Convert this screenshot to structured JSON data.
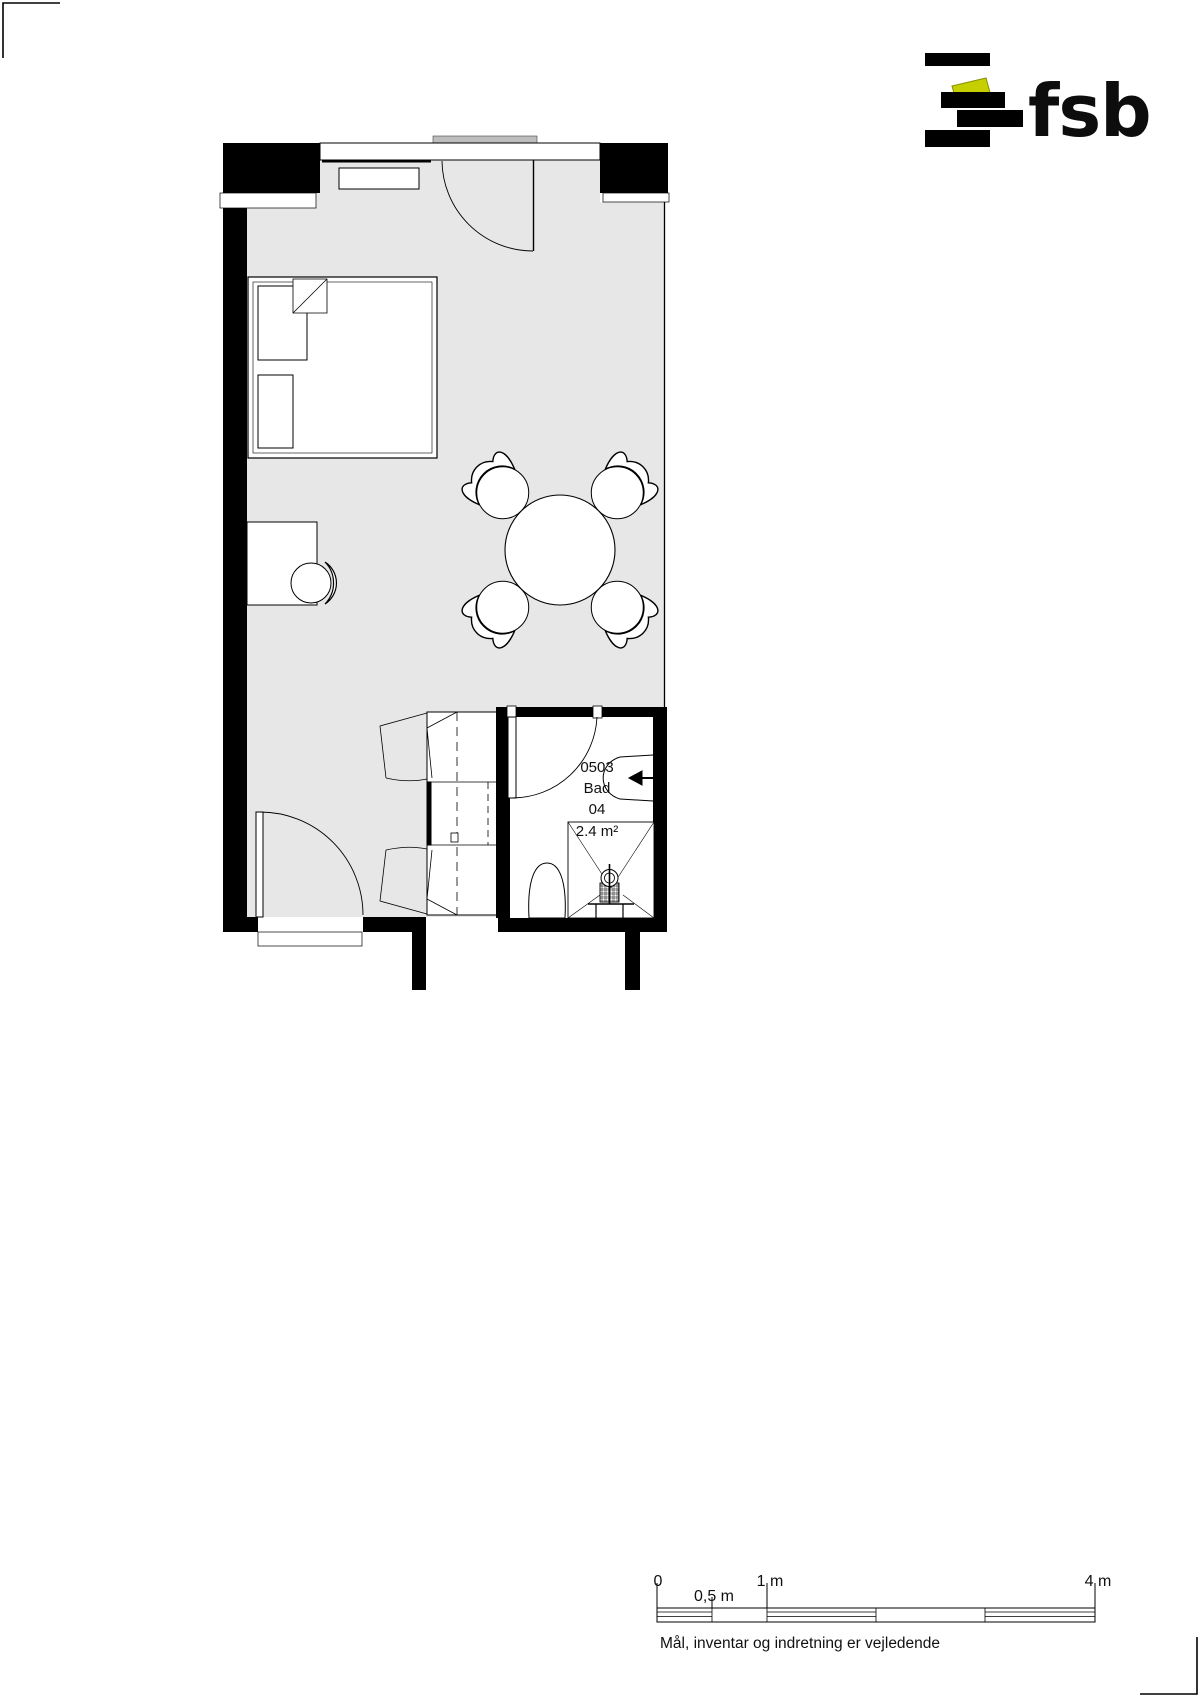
{
  "page": {
    "background": "#ffffff"
  },
  "logo": {
    "wordmark": "fsb",
    "bar_color": "#000000",
    "accent_color": "#c6d000"
  },
  "floor_plan": {
    "room_fill": "#e7e7e7",
    "threshold_fill": "#bdbdbd",
    "wall_color": "#000000",
    "bathroom": {
      "id": "0503",
      "name": "Bad",
      "number": "04",
      "area": "2.4 m²"
    }
  },
  "scale_bar": {
    "tick_labels": [
      "0",
      "0,5 m",
      "1 m",
      "4 m"
    ],
    "disclaimer": "Mål, inventar og indretning er vejledende"
  }
}
